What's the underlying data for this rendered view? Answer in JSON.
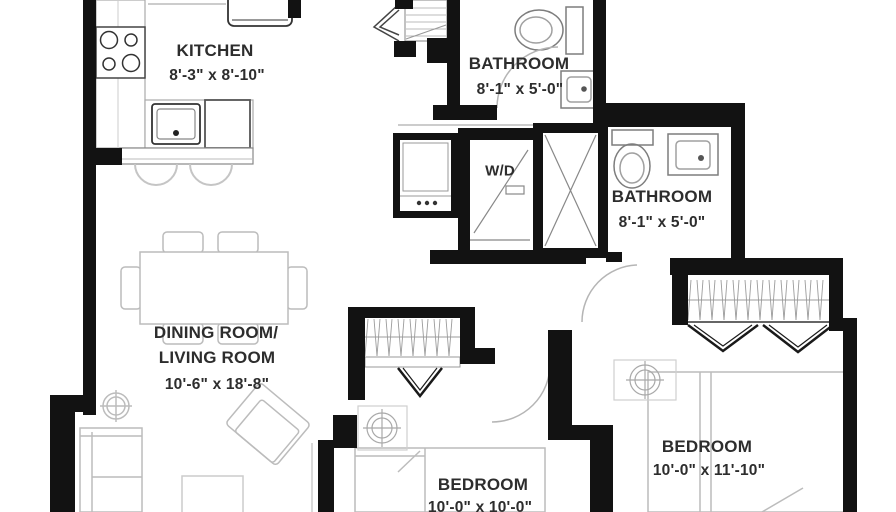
{
  "rooms": {
    "kitchen": {
      "name": "KITCHEN",
      "dimensions": "8'-3\" x 8'-10\""
    },
    "bathroom_top": {
      "name": "BATHROOM",
      "dimensions": "8'-1\" x 5'-0\""
    },
    "bathroom_right": {
      "name": "BATHROOM",
      "dimensions": "8'-1\" x 5'-0\""
    },
    "dining_living": {
      "name_line1": "DINING ROOM/",
      "name_line2": "LIVING ROOM",
      "dimensions": "10'-6\" x 18'-8\""
    },
    "bedroom_middle": {
      "name": "BEDROOM",
      "dimensions": "10'-0\" x 10'-0\""
    },
    "bedroom_right": {
      "name": "BEDROOM",
      "dimensions": "10'-0\" x 11'-10\""
    },
    "laundry": {
      "name": "W/D"
    }
  },
  "fixture_icons": [
    "stove-icon",
    "kitchen-sink-icon",
    "refrigerator-icon",
    "dishwasher-icon",
    "bar-stool-icon",
    "toilet-icon",
    "vanity-sink-icon",
    "shower-icon",
    "washer-dryer-icon",
    "closet-icon",
    "dining-table-icon",
    "chair-icon",
    "sofa-icon",
    "armchair-icon",
    "bed-icon",
    "ceiling-light-icon",
    "door-swing-icon"
  ],
  "colors": {
    "wall": "#121212",
    "fixture": "#7d7d7d",
    "furniture": "#bcbcbc",
    "hatch": "#9b9b9b",
    "text": "#2d2d2d",
    "background": "#ffffff"
  }
}
